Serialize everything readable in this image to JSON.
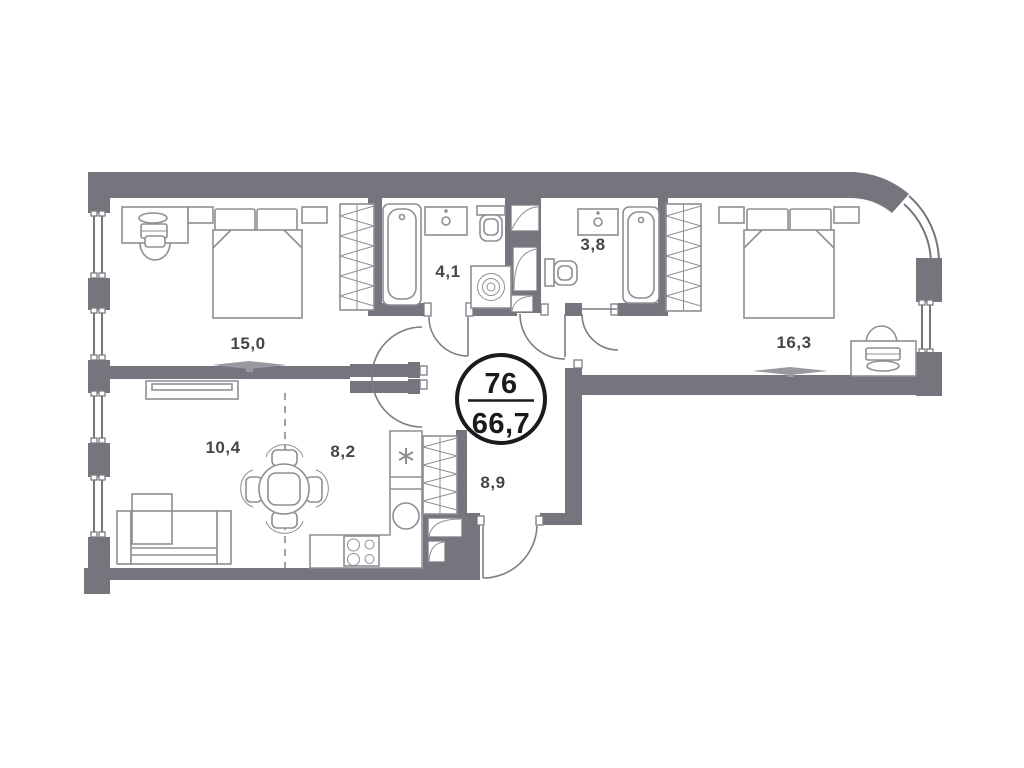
{
  "unit": {
    "number": "76",
    "total_area": "66,7"
  },
  "rooms": [
    {
      "id": "bedroom-left",
      "area": "15,0"
    },
    {
      "id": "bathroom-left",
      "area": "4,1"
    },
    {
      "id": "bathroom-right",
      "area": "3,8"
    },
    {
      "id": "bedroom-right",
      "area": "16,3"
    },
    {
      "id": "living-room",
      "area": "10,4"
    },
    {
      "id": "kitchen",
      "area": "8,2"
    },
    {
      "id": "hallway",
      "area": "8,9"
    }
  ],
  "colors": {
    "wall": "#77747E",
    "furniture": "#8F8D96",
    "text": "#47454C",
    "badge": "#1B1B1E",
    "background": "#FFFFFF"
  }
}
